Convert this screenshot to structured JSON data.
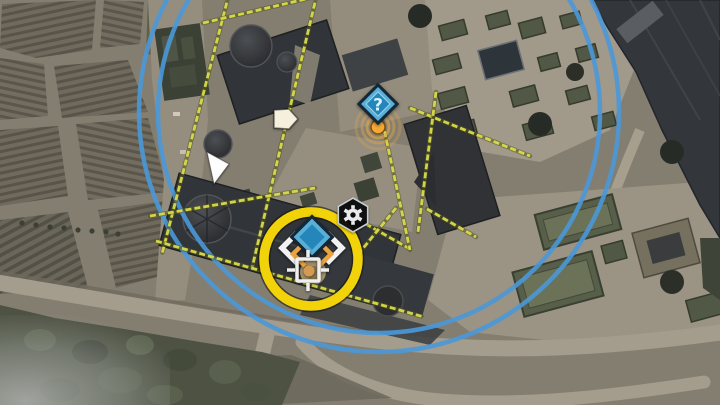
{
  "screen": {
    "kind": "in-game tactical map view",
    "width": 720,
    "height": 405
  },
  "overlay": {
    "glyphs": {
      "unknown": "?"
    },
    "colors": {
      "patrol_yellow": "#d9dc4b",
      "patrol_under": "#55571d",
      "radius_blue": "#4a98d8",
      "highlight_yellow": "#f2d309",
      "marker_navy": "#142736",
      "marker_blue_band": "#58b0d9",
      "marker_blue_core": "#2586ba",
      "ping_orange": "#f4a934",
      "chevron_white": "#f2f2f2",
      "chevron_orange": "#eaa33f"
    },
    "radius_circles": {
      "cx": 379,
      "cy": 112,
      "radii": [
        221,
        240
      ],
      "color": "#4a98d8",
      "width": 4.5,
      "opacity": 0.9
    },
    "patrol_segments": [
      [
        229,
        -6,
        162,
        254
      ],
      [
        203,
        23,
        327,
        -6
      ],
      [
        317,
        -6,
        252,
        268
      ],
      [
        156,
        241,
        424,
        317
      ],
      [
        150,
        216,
        315,
        188
      ],
      [
        410,
        108,
        530,
        156
      ],
      [
        436,
        92,
        418,
        232
      ],
      [
        350,
        215,
        410,
        249
      ],
      [
        396,
        208,
        360,
        252
      ],
      [
        427,
        209,
        476,
        237
      ],
      [
        377,
        96,
        410,
        250
      ]
    ],
    "highlight_ring": {
      "cx": 311,
      "cy": 259,
      "r": 47,
      "width": 9.5,
      "color": "#f2d309",
      "edge_color": "rgba(22,22,14,0.6)"
    },
    "ping": {
      "cx": 378,
      "cy": 127,
      "dot_r": 7,
      "dot_color": "#f4a934",
      "dot_edge": "#7e5212",
      "ring_color": "#e0a64b",
      "rings": [
        {
          "r": 11,
          "o": 0.62
        },
        {
          "r": 16,
          "o": 0.45
        },
        {
          "r": 22,
          "o": 0.3
        }
      ]
    },
    "markers": [
      {
        "id": "unknown-area",
        "type": "undiscovered-intel-diamond",
        "x": 378,
        "y": 104
      },
      {
        "id": "selected-objective",
        "type": "selected-marker-diamond",
        "x": 312,
        "y": 237
      },
      {
        "id": "objective-crosshair",
        "type": "target-crosshair",
        "x": 308,
        "y": 270
      },
      {
        "id": "gear-item",
        "type": "tool-hexagon",
        "x": 353,
        "y": 215
      },
      {
        "id": "exit-pentagon",
        "type": "exit-arrow-marker",
        "x": 286,
        "y": 119
      },
      {
        "id": "player-arrow",
        "type": "player-position-cursor",
        "x": 216,
        "y": 168
      }
    ]
  }
}
